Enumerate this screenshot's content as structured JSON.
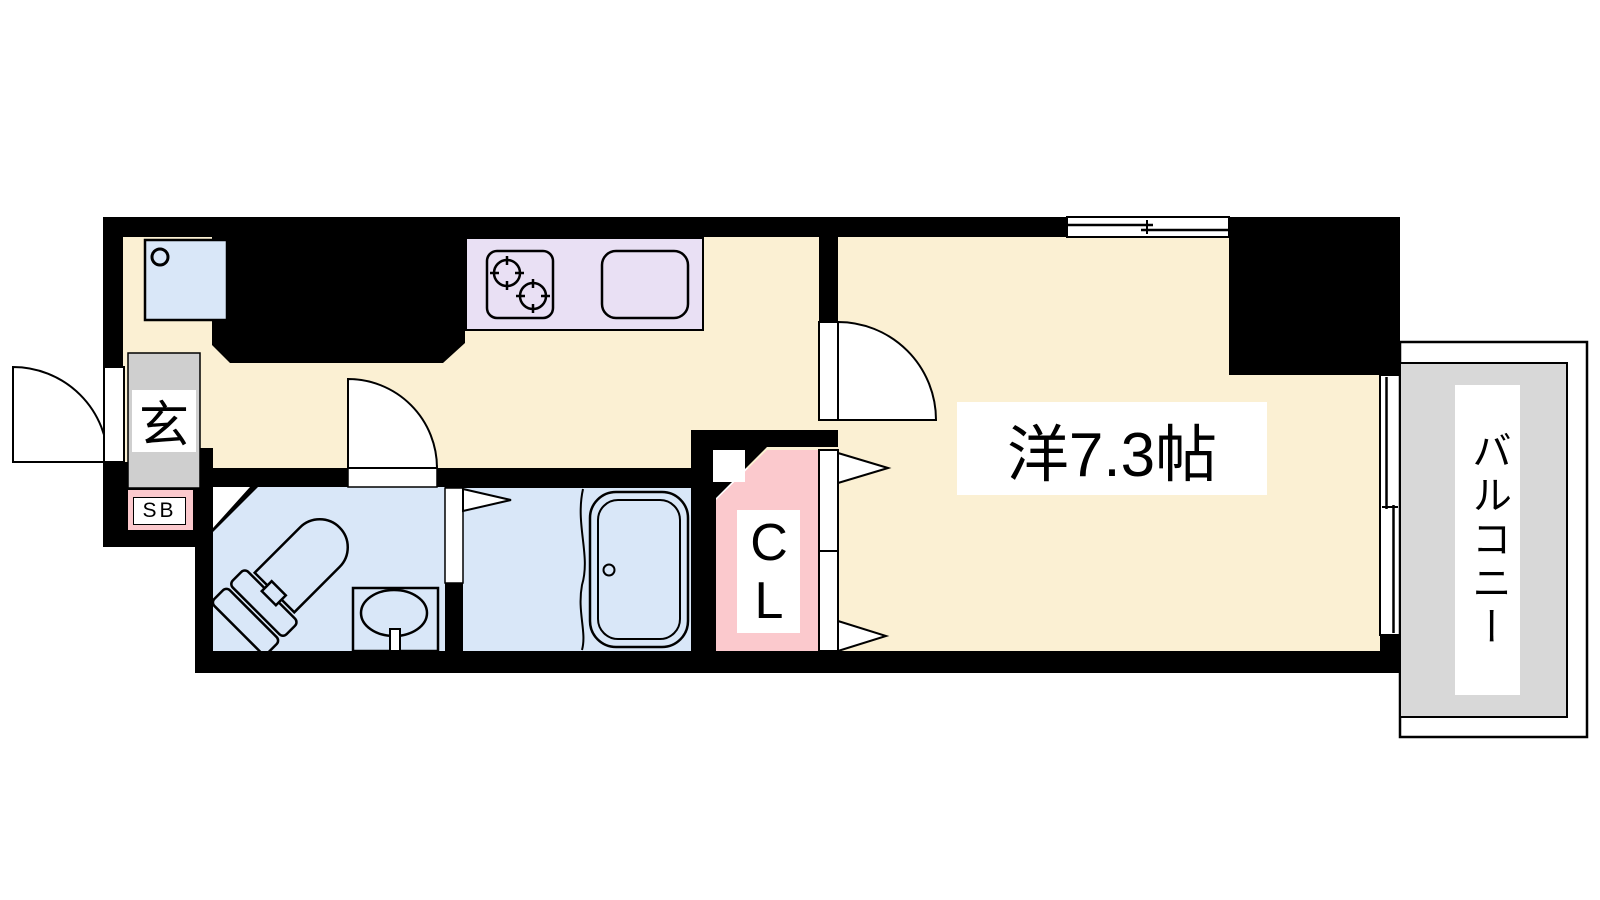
{
  "plan": {
    "title": "1K apartment floor plan",
    "rooms": {
      "entrance": {
        "label": "玄"
      },
      "shoe_box": {
        "label": "SB"
      },
      "closet": {
        "label": "CL"
      },
      "western_room": {
        "label": "洋7.3帖"
      },
      "balcony": {
        "label": "バルコニー"
      }
    },
    "fixtures": [
      "washing-machine-pan",
      "kitchen-counter",
      "stove-burners",
      "kitchen-sink",
      "toilet",
      "washbasin",
      "bathtub",
      "entrance-door",
      "washroom-door",
      "room-door",
      "bath-folding-door",
      "closet-folding-doors",
      "window"
    ],
    "colors": {
      "background": "#FFFFFF",
      "wall": "#000000",
      "line": "#000000",
      "floor": "#FBF0D3",
      "water_blue": "#D9E7F8",
      "kitchen_lavender": "#E9E0F4",
      "pink": "#FBC9CD",
      "entrance_gray": "#CFCFCF",
      "balcony_gray": "#D8D8D8",
      "label_bg": "#FFFFFF"
    }
  }
}
